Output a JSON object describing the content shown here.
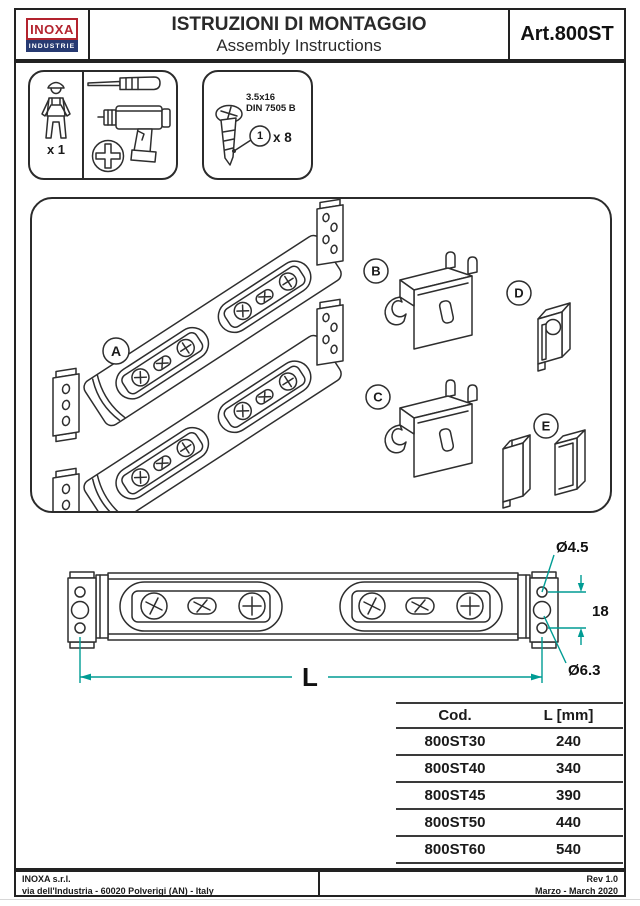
{
  "header": {
    "logo_line1": "INOXA",
    "logo_line2": "INDUSTRIE",
    "title_line1": "ISTRUZIONI DI MONTAGGIO",
    "title_line2": "Assembly Instructions",
    "article": "Art.800ST"
  },
  "tools": {
    "installer_quantity": "x 1"
  },
  "hardware": {
    "screw_size": "3.5x16",
    "screw_standard": "DIN 7505 B",
    "callout_number": "1",
    "quantity": "x 8"
  },
  "parts": {
    "a": "A",
    "b": "B",
    "c": "C",
    "d": "D",
    "e": "E"
  },
  "dimensions": {
    "top_hole_diameter": "Ø4.5",
    "hole_spacing": "18",
    "bottom_hole_diameter": "Ø6.3",
    "length_symbol": "L"
  },
  "size_table": {
    "col_code": "Cod.",
    "col_length": "L [mm]",
    "rows": [
      [
        "800ST30",
        "240"
      ],
      [
        "800ST40",
        "340"
      ],
      [
        "800ST45",
        "390"
      ],
      [
        "800ST50",
        "440"
      ],
      [
        "800ST60",
        "540"
      ]
    ]
  },
  "footer": {
    "company": "INOXA s.r.l.",
    "address": "via dell'Industria - 60020 Polverigi (AN) - Italy",
    "revision": "Rev 1.0",
    "date": "Marzo - March 2020"
  },
  "colors": {
    "brand_red": "#b3232e",
    "brand_navy": "#273a72",
    "dimension_teal": "#009c94"
  }
}
